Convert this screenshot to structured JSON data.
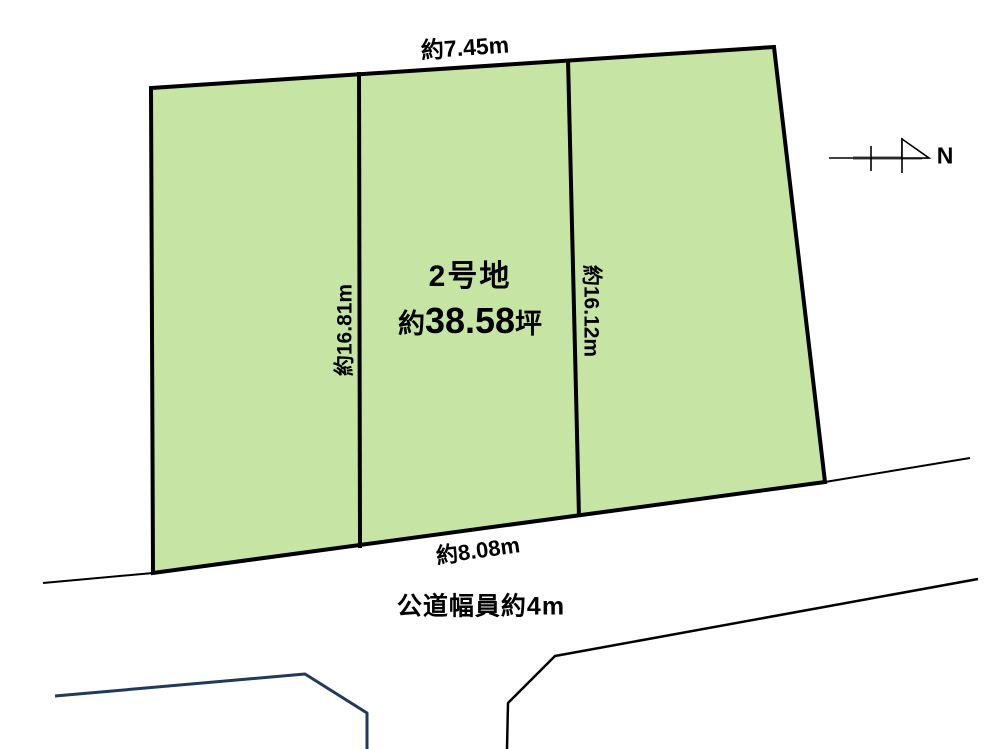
{
  "labels": {
    "top_width": "約7.45m",
    "left_depth": "約16.81m",
    "right_depth": "約16.12m",
    "bottom_width": "約8.08m",
    "lot_name": "2号地",
    "area_prefix": "約",
    "area_value": "38.58",
    "area_unit": "坪",
    "road": "公道幅員約4m",
    "north": "N"
  },
  "colors": {
    "background": "#ffffff",
    "plot_fill": "#c6e5a4",
    "outline": "#000000",
    "neighbor_line": "#1f3a5c",
    "compass_bar": "#a6a6a6"
  }
}
